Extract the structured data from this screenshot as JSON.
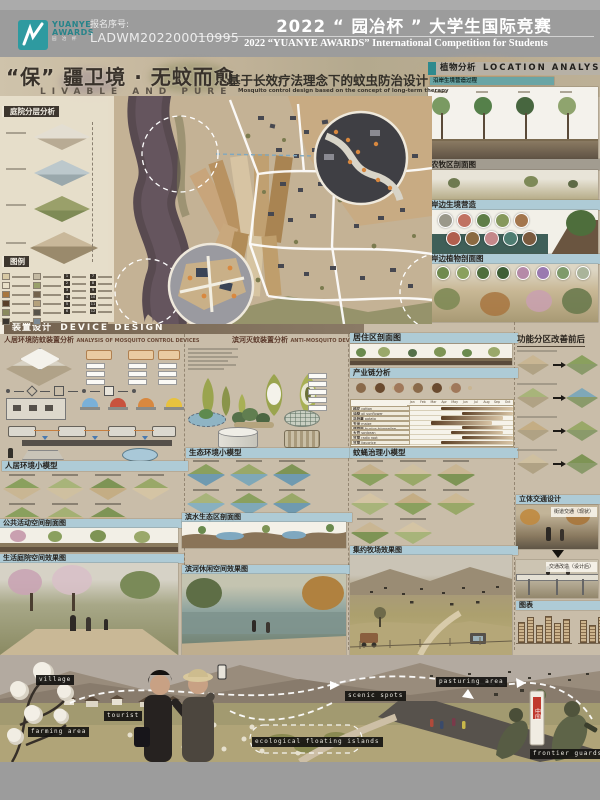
{
  "header": {
    "reg_label": "报名序号:",
    "reg_number": "LADWM202200010995",
    "title_cn": "2022 “ 园冶杯 ” 大学生国际竞赛",
    "title_en": "2022 “YUANYE AWARDS” International Competition for  Students",
    "logo": {
      "line1": "YUANYE",
      "line2": "AWARDS",
      "cn": "园 冶 杯"
    }
  },
  "hero": {
    "title_cn": "“保” 疆卫境 · 无蚊而愈",
    "title_en": "LIVABLE AND PURE",
    "subtitle_cn": "基于长效疗法理念下的蚊虫防治设计",
    "subtitle_en": "Mosquito control design based on the concept of long-term therapy"
  },
  "left": {
    "courtyard_title": "庭院分层分析",
    "legend_title": "图例",
    "legend_numbers": [
      {
        "n": "1"
      },
      {
        "n": "2"
      },
      {
        "n": "3"
      },
      {
        "n": "4"
      },
      {
        "n": "5"
      },
      {
        "n": "6"
      },
      {
        "n": "7"
      },
      {
        "n": "8"
      },
      {
        "n": "9"
      },
      {
        "n": "10"
      },
      {
        "n": "11"
      },
      {
        "n": "12"
      }
    ]
  },
  "plants": {
    "title_cn": "植物分析",
    "title_en": "LOCATION ANALYSIS",
    "process": "沿岸生境营造过程",
    "farm_section": "农牧区剖面图",
    "shore_habitat": "岸边生境营造",
    "shore_plants": "岸边植物剖面图",
    "tree_colors": [
      {
        "c": "#7a9a62"
      },
      {
        "c": "#55804a"
      },
      {
        "c": "#47663f"
      },
      {
        "c": "#8fa46e"
      }
    ],
    "species_row1": [
      {
        "c": "#9a988a"
      },
      {
        "c": "#c07262"
      },
      {
        "c": "#5f7e48"
      },
      {
        "c": "#86985c"
      },
      {
        "c": "#a3764d"
      }
    ],
    "species_row2": [
      {
        "c": "#b05f4e"
      },
      {
        "c": "#8a6a42"
      },
      {
        "c": "#c4888a"
      },
      {
        "c": "#4e7d72"
      },
      {
        "c": "#7a5a3e"
      }
    ],
    "plant_circles": [
      {
        "c": "#6f8a4e"
      },
      {
        "c": "#8aa05e"
      },
      {
        "c": "#4e6e3c"
      },
      {
        "c": "#3e5e35"
      },
      {
        "c": "#b58aa8"
      },
      {
        "c": "#9a7ab0"
      },
      {
        "c": "#7e9a6a"
      },
      {
        "c": "#aab49a"
      }
    ]
  },
  "device": {
    "band_cn": "装置设计",
    "band_en": "DEVICE DESIGN",
    "living_cn": "人居环境防蚊装置分析",
    "living_en": "ANALYSIS OF MOSQUITO CONTROL DEVICES",
    "river_cn": "滨河灭蚊装置分析",
    "river_en": "ANTI-MOSQUITO DEVICE",
    "lamp_colors": [
      {
        "c": "#7ab0d8"
      },
      {
        "c": "#c8523e"
      },
      {
        "c": "#d8883f"
      },
      {
        "c": "#e8c23e"
      }
    ]
  },
  "sections": {
    "residential": "居住区剖面图",
    "industry": "产业链分析",
    "zoning": "功能分区改善前后",
    "model_living": "人居环境小模型",
    "model_eco": "生态环境小模型",
    "model_mosquito": "蚊蝇治理小模型",
    "traffic": "立体交通设计",
    "traffic_current": "街道交通（现状）",
    "traffic_after": "交通改造（设计后）",
    "public_section": "公共活动空间剖面图",
    "waterfront_section": "滨水生态区剖面图",
    "courtyard_render": "生活庭院空间效果图",
    "riverside_render": "滨河休闲空间效果图",
    "pasture_render": "集约牧场效果图",
    "charts": "图表"
  },
  "chart_data": {
    "type": "gantt",
    "title": "产业链分析 — 作物种植月历",
    "months": [
      {
        "m": "Jan"
      },
      {
        "m": "Feb"
      },
      {
        "m": "Mar"
      },
      {
        "m": "Apr"
      },
      {
        "m": "May"
      },
      {
        "m": "Jun"
      },
      {
        "m": "Jul"
      },
      {
        "m": "Aug"
      },
      {
        "m": "Sep"
      },
      {
        "m": "Oct"
      }
    ],
    "crops": [
      {
        "cn": "棉花",
        "en": "cotton",
        "l": 30,
        "w": 70
      },
      {
        "cn": "油葵",
        "en": "oil sunflower",
        "l": 50,
        "w": 50
      },
      {
        "cn": "马铃薯",
        "en": "potato",
        "l": 30,
        "w": 60
      },
      {
        "cn": "玉米",
        "en": "maize",
        "l": 20,
        "w": 60
      },
      {
        "cn": "葫芦巴",
        "en": "fructus trigonellae",
        "l": 50,
        "w": 40
      },
      {
        "cn": "大豆",
        "en": "soybean",
        "l": 40,
        "w": 50
      },
      {
        "cn": "甘草",
        "en": "radix root",
        "l": 50,
        "w": 50
      },
      {
        "cn": "甘草",
        "en": "liquorice",
        "l": 30,
        "w": 70
      }
    ],
    "mini_bars_1": [
      {
        "v": 62
      },
      {
        "v": 80
      },
      {
        "v": 55
      },
      {
        "v": 84
      },
      {
        "v": 60
      },
      {
        "v": 72
      }
    ],
    "mini_bars_2": [
      {
        "v": 70
      },
      {
        "v": 52
      },
      {
        "v": 80
      },
      {
        "v": 58
      },
      {
        "v": 74
      },
      {
        "v": 64
      }
    ]
  },
  "bottom": {
    "labels": [
      {
        "text": "village"
      },
      {
        "text": "tourist"
      },
      {
        "text": "farming area"
      },
      {
        "text": "ecological floating islands"
      },
      {
        "text": "scenic spots"
      },
      {
        "text": "pasturing area"
      },
      {
        "text": "frontier guards"
      }
    ],
    "border_marker": "中国"
  },
  "palette": {
    "accent_teal": "#2e9aa0",
    "bar_blue": "#aecbd6",
    "band_brown": "#73624f",
    "header_gray": "#9c9c9c",
    "poster_tan": "#c9bda9"
  },
  "decor": {
    "legend_swatches_a": [
      {
        "c": "#d8c9a4"
      },
      {
        "c": "#e9e0c8"
      },
      {
        "c": "#a8773f"
      },
      {
        "c": "#5a3f2a"
      },
      {
        "c": "#8a8a5e"
      },
      {
        "c": "#3a3530"
      }
    ],
    "legend_swatches_b": [
      {
        "c": "#c3b9a2"
      },
      {
        "c": "#99a06a"
      },
      {
        "c": "#74634c"
      },
      {
        "c": "#b4a17c"
      },
      {
        "c": "#58544a"
      },
      {
        "c": "#7d8a94"
      }
    ],
    "tilesA": [
      {
        "c1": "#8aa05e",
        "c2": "#c9b693"
      },
      {
        "c1": "#a8b47a",
        "c2": "#cfc0a0"
      },
      {
        "c1": "#7e9455",
        "c2": "#c4ad84"
      },
      {
        "c1": "#99a868",
        "c2": "#d4c4a4"
      },
      {
        "c1": "#8aa05e",
        "c2": "#c9b693"
      },
      {
        "c1": "#a4b074",
        "c2": "#ccb994"
      },
      {
        "c1": "#7e9455",
        "c2": "#c9b693"
      }
    ],
    "tilesB": [
      {
        "c1": "#8aa05e",
        "c2": "#6f9ab0"
      },
      {
        "c1": "#99a868",
        "c2": "#7fa8b8"
      },
      {
        "c1": "#7e9455",
        "c2": "#6f9ab0"
      },
      {
        "c1": "#a8b47a",
        "c2": "#88b0c0"
      },
      {
        "c1": "#8aa05e",
        "c2": "#7fa8b8"
      },
      {
        "c1": "#99a868",
        "c2": "#6f9ab0"
      },
      {
        "c1": "#7e9455",
        "c2": "#7fa8b8"
      },
      {
        "c1": "#a8b47a",
        "c2": "#88b0c0"
      }
    ],
    "tilesC": [
      {
        "c1": "#c4b08a",
        "c2": "#8aa05e"
      },
      {
        "c1": "#cfc0a0",
        "c2": "#99a868"
      },
      {
        "c1": "#c9b693",
        "c2": "#7e9455"
      },
      {
        "c1": "#d4c4a4",
        "c2": "#a8b47a"
      },
      {
        "c1": "#c4ad84",
        "c2": "#8aa05e"
      },
      {
        "c1": "#ccb994",
        "c2": "#99a868"
      },
      {
        "c1": "#c9b693",
        "c2": "#7e9455"
      },
      {
        "c1": "#d4c4a4",
        "c2": "#a8b47a"
      }
    ],
    "pairs": [
      {
        "c1": "#c9b693",
        "c2": "#8aa05e"
      },
      {
        "c1": "#a8b47a",
        "c2": "#7fa8b8"
      },
      {
        "c1": "#c4ad84",
        "c2": "#99a868"
      },
      {
        "c1": "#cfc0a0",
        "c2": "#7e9455"
      }
    ],
    "flow": [
      {
        "c": "#8a6a4a"
      },
      {
        "c": "#6a4a2e"
      },
      {
        "c": "#a0785a"
      },
      {
        "c": "#8a6a4a"
      },
      {
        "c": "#6a4a2e"
      },
      {
        "c": "#a0785a"
      }
    ]
  }
}
